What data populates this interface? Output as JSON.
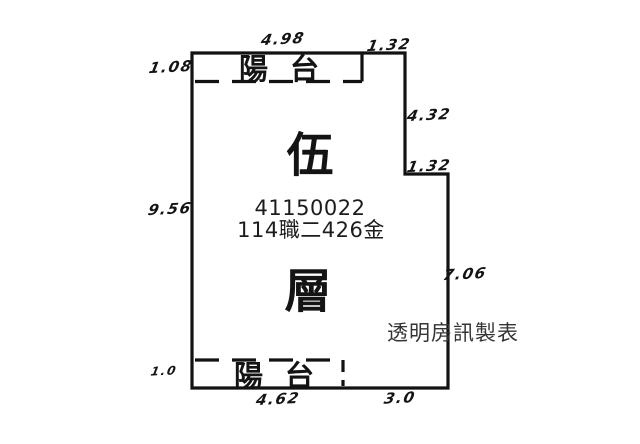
{
  "diagram": {
    "type": "floor-plan-survey-sketch",
    "floor_char_top": "伍",
    "floor_char_bottom": "層",
    "registration_number": "41150022",
    "case_number": "114職二426金",
    "watermark": "透明房訊製表",
    "balcony_top": {
      "label": "陽台"
    },
    "balcony_bottom": {
      "label": "陽台"
    },
    "dimensions": {
      "top_width": "4.98",
      "top_right_width": "1.32",
      "balcony_top_height": "1.08",
      "right_upper_height": "4.32",
      "right_step_width": "1.32",
      "left_height": "9.56",
      "right_lower_height": "7.06",
      "balcony_bottom_height": "1.0",
      "bottom_left_width": "4.62",
      "bottom_right_width": "3.0"
    },
    "colors": {
      "line": "#121212",
      "background": "#ffffff",
      "watermark_text": "#343434"
    }
  }
}
